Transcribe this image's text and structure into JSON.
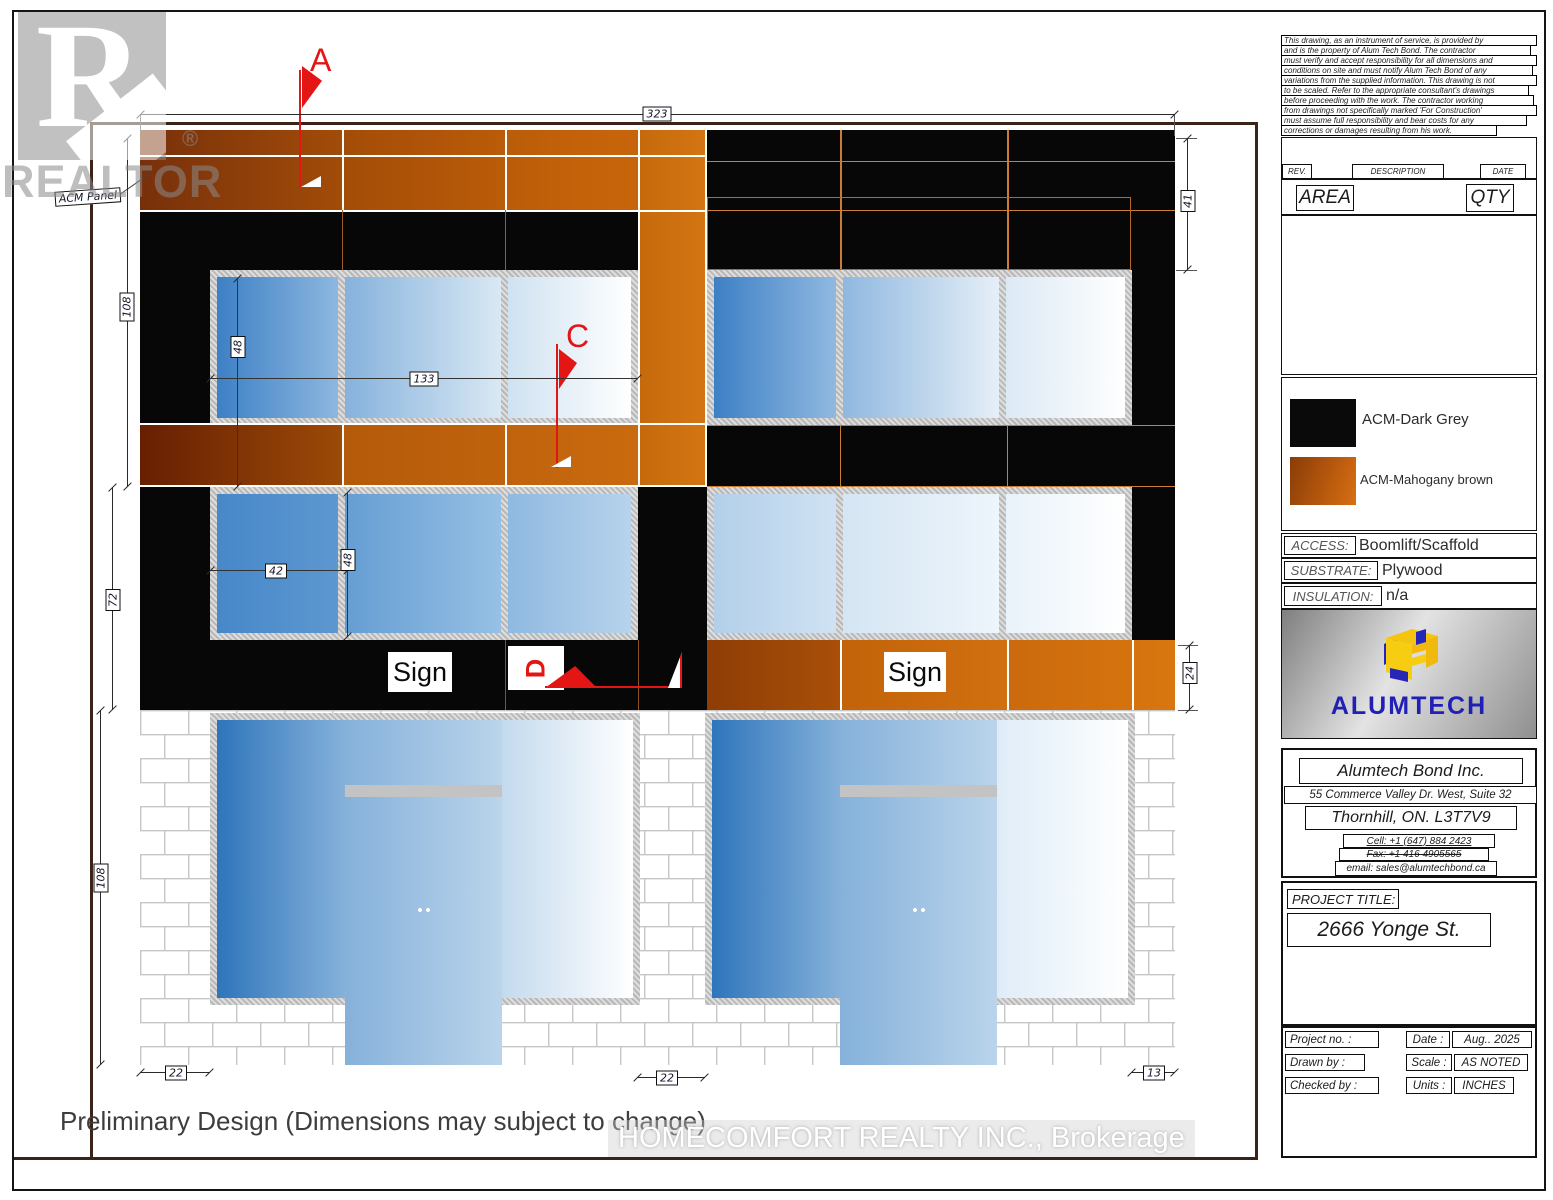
{
  "watermark": {
    "realtor_logo_letter": "R",
    "realtor_text": "REALTOR",
    "registered": "®",
    "brokerage_text": "HOMECOMFORT REALTY INC., Brokerage"
  },
  "notes": {
    "preliminary": "Preliminary Design (Dimensions may subject to change)",
    "acm_panel_label": "ACM Panel"
  },
  "flags": {
    "a": "A",
    "c": "C",
    "d": "D"
  },
  "signs": {
    "left": "Sign",
    "right": "Sign"
  },
  "dimensions": {
    "overall_width": "323",
    "top_band_height": "41",
    "upper_left_height": "108",
    "window1_height": "48",
    "window1_width": "133",
    "mid_left_height": "72",
    "window2_width": "42",
    "window2_height": "48",
    "sign_band_height": "24",
    "lower_left_height": "108",
    "bottom_left_offset": "22",
    "bottom_mid_offset": "22",
    "bottom_right_offset": "13"
  },
  "title_block": {
    "disclaimer_lines": [
      "This drawing, as an instrument of service, is provided by",
      "and is the property of Alum Tech Bond. The contractor",
      "must verify and accept responsibility for all dimensions and",
      "conditions on site and must notify Alum Tech Bond of any",
      "variations from the supplied information. This drawing is not",
      "to be scaled. Refer to the appropriate consultant's drawings",
      "before proceeding with the work. The contractor working",
      "from drawings not specifically marked 'For Construction'",
      "must assume full responsibility and bear costs for any",
      "corrections or damages resulting from his work."
    ],
    "revision_table": {
      "rev": "REV.",
      "description": "DESCRIPTION",
      "date": "DATE"
    },
    "area_table": {
      "area": "AREA",
      "qty": "QTY"
    },
    "legend": {
      "dark": "ACM-Dark Grey",
      "brown": "ACM-Mahogany brown"
    },
    "specs": {
      "access_label": "ACCESS:",
      "access_value": "Boomlift/Scaffold",
      "substrate_label": "SUBSTRATE:",
      "substrate_value": "Plywood",
      "insulation_label": "INSULATION:",
      "insulation_value": "n/a"
    },
    "logo": {
      "wordmark": "ALUMTECH"
    },
    "company": {
      "name": "Alumtech Bond Inc.",
      "address_line1": "55 Commerce Valley Dr. West, Suite 32",
      "address_line2": "Thornhill, ON. L3T7V9",
      "cell": "Cell: +1 (647) 884 2423",
      "fax": "Fax: +1 416 4905565",
      "email": "email: sales@alumtechbond.ca"
    },
    "project": {
      "label": "PROJECT TITLE:",
      "title": "2666 Yonge St."
    },
    "info": {
      "project_no_label": "Project no. :",
      "drawn_by_label": "Drawn by :",
      "checked_by_label": "Checked by :",
      "date_label": "Date :",
      "date_value": "Aug.. 2025",
      "scale_label": "Scale :",
      "scale_value": "AS NOTED",
      "units_label": "Units :",
      "units_value": "INCHES"
    }
  },
  "colors": {
    "acm_dark_grey": "#070707",
    "acm_mahogany_brown": "#c4650a",
    "window_blue": "#2e75bb",
    "flag_red": "#e31515",
    "brick_mortar": "#c6c6c6",
    "logo_blue": "#2020b4",
    "logo_yellow": "#f4c40f"
  }
}
